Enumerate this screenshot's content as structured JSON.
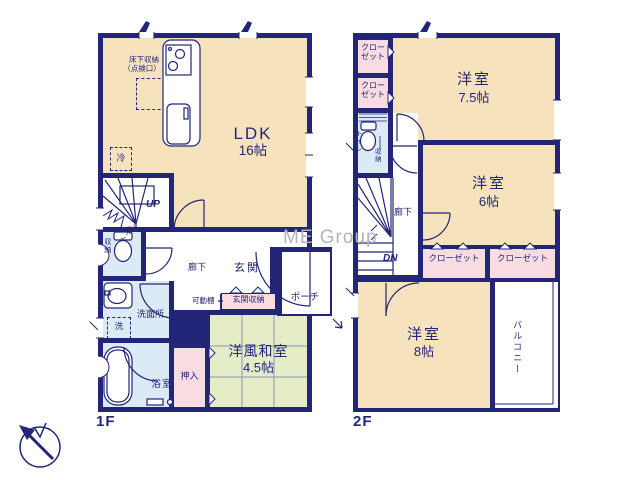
{
  "watermark": "ME Group",
  "floor1": {
    "label": "1F",
    "ldk": {
      "name": "LDK",
      "size": "16帖"
    },
    "underfloor_storage": "床下収納",
    "inspection_port": "（点検口）",
    "fridge": "冷",
    "up": "UP",
    "storage": "収納",
    "toilet": "トイレ",
    "hallway": "廊下",
    "entrance": "玄関",
    "movable_shelf": "可動棚",
    "entrance_storage": "玄関収納",
    "porch": "ポーチ",
    "washer": "洗",
    "washroom": "洗面所",
    "bathroom": "浴室",
    "oshiire": "押入",
    "western_japanese_room": {
      "name": "洋風和室",
      "size": "4.5帖"
    }
  },
  "floor2": {
    "label": "2F",
    "closet": "クローゼット",
    "toilet": "トイレ",
    "storage": "収納",
    "hallway": "廊下",
    "dn": "DN",
    "western_room_75": {
      "name": "洋室",
      "size": "7.5帖"
    },
    "western_room_6": {
      "name": "洋室",
      "size": "6帖"
    },
    "western_room_8": {
      "name": "洋室",
      "size": "8帖"
    },
    "balcony": "バルコニー"
  },
  "colors": {
    "wall": "#232578",
    "room_cream": "#f6e3bd",
    "room_green": "#e5edc6",
    "room_pink": "#f8dce1",
    "room_blue": "#dceaf6",
    "text": "#232578",
    "watermark": "#b3b3bc"
  }
}
